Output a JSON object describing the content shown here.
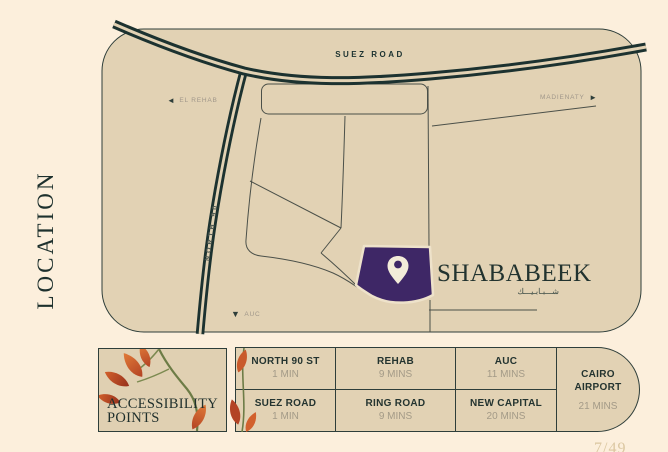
{
  "page": {
    "vertical_title": "LOCATION",
    "page_number": "7/49",
    "colors": {
      "background": "#FCEFDC",
      "map_fill": "#E2D2B4",
      "road_dark": "#1C3230",
      "brand_purple": "#3E2766",
      "muted_label": "#A0978A"
    }
  },
  "map": {
    "labels": {
      "suez_road": "SUEZ ROAD",
      "el_rehab": "EL REHAB",
      "el_rehab_arrow": "◄",
      "madienaty": "MADIENATY",
      "madienaty_arrow": "►",
      "north_90": "NORTH 90",
      "auc": "AUC",
      "auc_arrow": "▼"
    },
    "brand": {
      "name": "SHABABEEK",
      "arabic": "شـــبـابـيـــك"
    }
  },
  "accessibility": {
    "title_line1": "ACCESSIBILITY",
    "title_line2": "POINTS",
    "cells": [
      {
        "label": "NORTH 90 ST",
        "time": "1 MIN"
      },
      {
        "label": "REHAB",
        "time": "9 MINS"
      },
      {
        "label": "AUC",
        "time": "11 MINS"
      },
      {
        "label": "SUEZ ROAD",
        "time": "1 MIN"
      },
      {
        "label": "RING ROAD",
        "time": "9 MINS"
      },
      {
        "label": "NEW CAPITAL",
        "time": "20 MINS"
      }
    ],
    "airport": {
      "line1": "CAIRO",
      "line2": "AIRPORT",
      "time": "21 MINS"
    }
  }
}
